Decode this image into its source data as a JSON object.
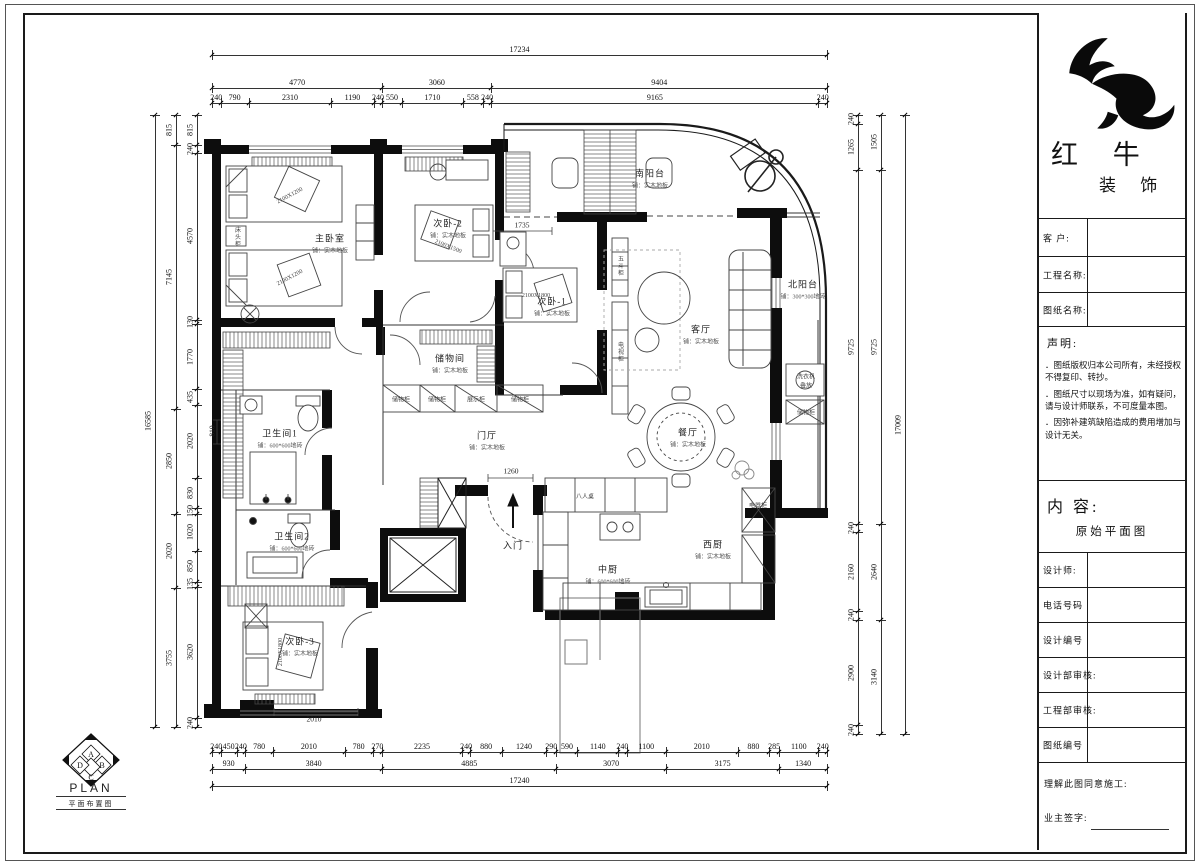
{
  "title_block": {
    "brand": {
      "logo": "bull-brush-logo",
      "name_line1": "红 牛",
      "name_line2": "装 饰"
    },
    "fields": {
      "customer": "客 户:",
      "project_name": "工程名称:",
      "drawing_name": "图纸名称:",
      "designer": "设计师:",
      "phone": "电话号码",
      "design_no": "设计编号",
      "design_dept_review": "设计部审核:",
      "eng_dept_review": "工程部审核:",
      "drawing_no": "图纸编号"
    },
    "statement": {
      "heading": "声明:",
      "items": [
        "．图纸版权归本公司所有，未经授权不得复印、转抄。",
        "．图纸尺寸以现场为准，如有疑问，请与设计师联系，不可度量本图。",
        "．因弥补建筑缺陷造成的费用增加与设计无关。"
      ]
    },
    "content": {
      "label": "内 容:",
      "value": "原始平面图"
    },
    "footer": {
      "agree": "理解此图同意施工:",
      "owner_sign": "业主签字:"
    }
  },
  "plan_logo": {
    "letters": [
      "A",
      "B",
      "C",
      "D"
    ],
    "title": "PLAN",
    "subtitle": "平面布置图"
  },
  "dims": {
    "top": [
      [
        17234
      ],
      [
        4770,
        3060,
        9404
      ],
      [
        240,
        790,
        2310,
        1190,
        240,
        550,
        1710,
        558,
        240,
        9165,
        240
      ]
    ],
    "bottom": [
      [
        240,
        450,
        240,
        780,
        2010,
        780,
        270,
        2235,
        240,
        880,
        1240,
        290,
        590,
        1140,
        240,
        1100,
        2010,
        880,
        285,
        1100,
        240
      ],
      [
        930,
        3840,
        4885,
        3070,
        3175,
        1340
      ],
      [
        17240
      ]
    ],
    "left": [
      [
        16585
      ],
      [
        815,
        7145,
        2850,
        2020,
        3755
      ],
      [
        815,
        240,
        4570,
        130,
        1770,
        435,
        2020,
        830,
        150,
        1020,
        850,
        135,
        3620,
        240
      ]
    ],
    "right": [
      [
        240,
        1265,
        9725,
        240,
        2160,
        240,
        2900,
        240
      ],
      [
        1505,
        9725,
        2640,
        3140
      ],
      [
        17009
      ]
    ]
  },
  "rooms": [
    {
      "name": "主卧室",
      "sub": "铺：实木地板",
      "x": 330,
      "y": 243
    },
    {
      "name": "次卧-2",
      "sub": "铺：实木地板",
      "x": 448,
      "y": 228
    },
    {
      "name": "次卧-1",
      "sub": "铺：实木地板",
      "x": 552,
      "y": 306
    },
    {
      "name": "次卧-3",
      "sub": "铺：实木地板",
      "x": 300,
      "y": 646
    },
    {
      "name": "储物间",
      "sub": "铺：实木地板",
      "x": 450,
      "y": 363
    },
    {
      "name": "卫生间1",
      "sub": "铺：600*600地砖",
      "x": 280,
      "y": 438
    },
    {
      "name": "卫生间2",
      "sub": "铺：600*600地砖",
      "x": 292,
      "y": 541
    },
    {
      "name": "门厅",
      "sub": "铺：实木地板",
      "x": 487,
      "y": 440
    },
    {
      "name": "入门",
      "sub": "",
      "x": 513,
      "y": 545
    },
    {
      "name": "南阳台",
      "sub": "铺：实木地板",
      "x": 650,
      "y": 178
    },
    {
      "name": "北阳台",
      "sub": "铺：300*300地砖",
      "x": 803,
      "y": 289
    },
    {
      "name": "客厅",
      "sub": "铺：实木地板",
      "x": 701,
      "y": 334
    },
    {
      "name": "餐厅",
      "sub": "铺：实木地板",
      "x": 688,
      "y": 437
    },
    {
      "name": "中厨",
      "sub": "铺：600*600地砖",
      "x": 608,
      "y": 574
    },
    {
      "name": "西厨",
      "sub": "铺：实木地板",
      "x": 713,
      "y": 549
    }
  ],
  "labels": [
    {
      "t": "2100X1200",
      "x": 290,
      "y": 196,
      "r": -28
    },
    {
      "t": "2100X1200",
      "x": 290,
      "y": 278,
      "r": -28
    },
    {
      "t": "2100X1500",
      "x": 448,
      "y": 247,
      "r": 22
    },
    {
      "t": "2100X1800",
      "x": 536,
      "y": 296,
      "r": 0
    },
    {
      "t": "2100X1800",
      "x": 281,
      "y": 652,
      "r": -90
    },
    {
      "t": "床头柜",
      "x": 237,
      "y": 237,
      "v": true
    },
    {
      "t": "五斗柜",
      "x": 620,
      "y": 266,
      "v": true
    },
    {
      "t": "电视柜",
      "x": 620,
      "y": 352,
      "v": true
    },
    {
      "t": "储物柜",
      "x": 401,
      "y": 399
    },
    {
      "t": "储物柜",
      "x": 437,
      "y": 399
    },
    {
      "t": "展示柜",
      "x": 476,
      "y": 399
    },
    {
      "t": "储物柜",
      "x": 520,
      "y": 399
    },
    {
      "t": "八人桌",
      "x": 585,
      "y": 496
    },
    {
      "t": "电器柜",
      "x": 758,
      "y": 505
    },
    {
      "t": "洗衣机",
      "x": 806,
      "y": 376
    },
    {
      "t": "叠放",
      "x": 806,
      "y": 385
    },
    {
      "t": "储物柜",
      "x": 806,
      "y": 412
    }
  ],
  "mini_dims": [
    {
      "t": "1735",
      "x": 522,
      "y": 225
    },
    {
      "t": "1260",
      "x": 511,
      "y": 471
    },
    {
      "t": "2010",
      "x": 314,
      "y": 719
    },
    {
      "t": "810",
      "x": 212,
      "y": 431,
      "v": true
    }
  ]
}
